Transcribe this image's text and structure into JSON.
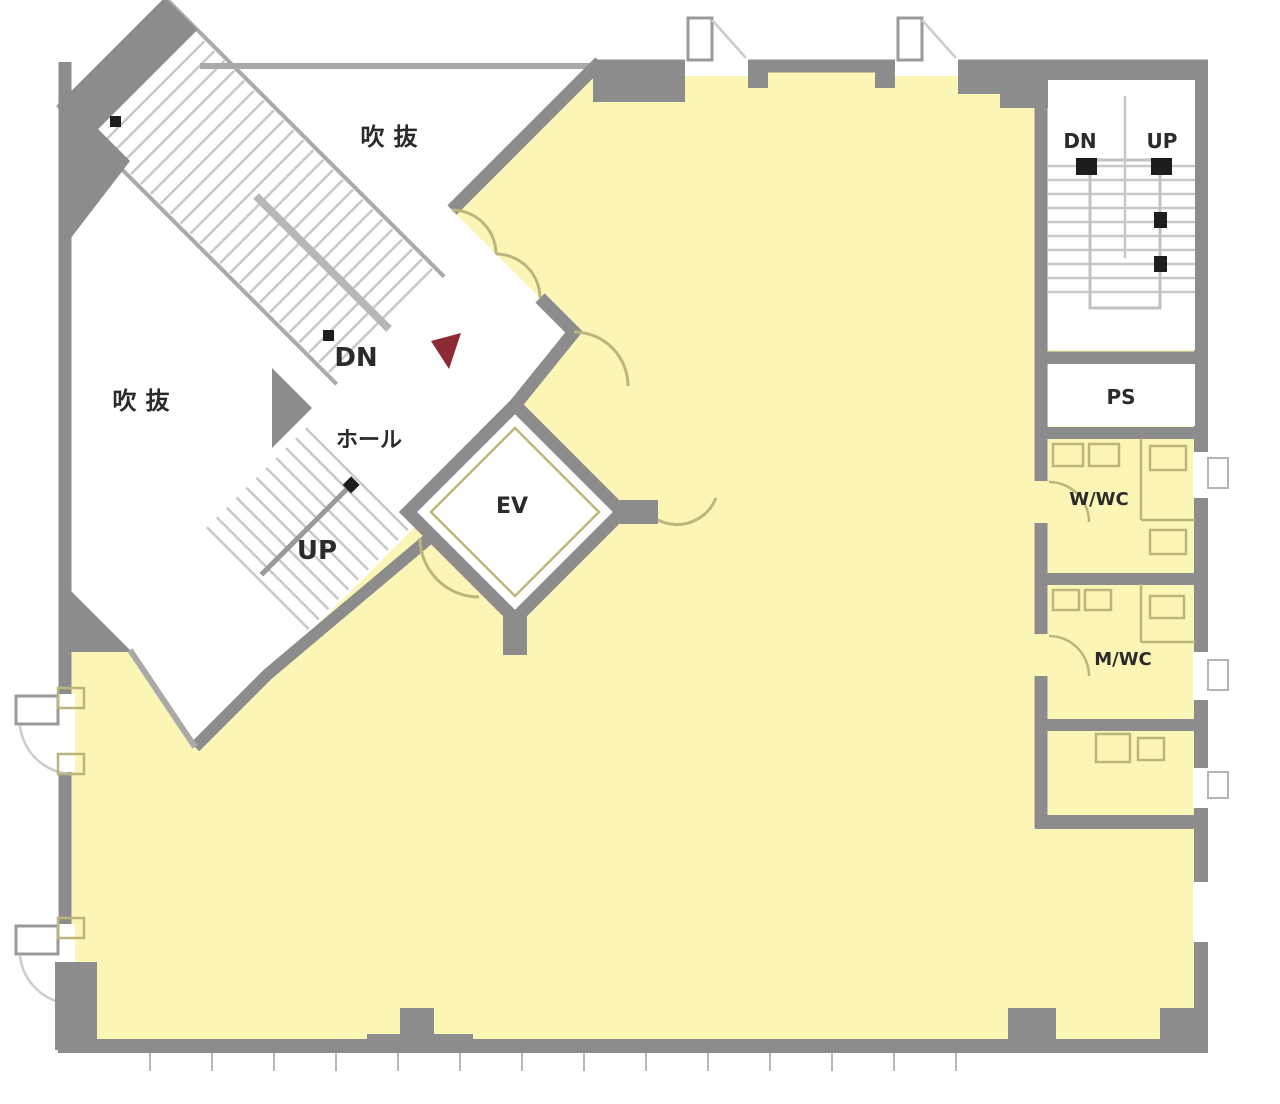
{
  "plan": {
    "labels": {
      "void_top": "吹抜",
      "void_left": "吹抜",
      "hall_dn": "DN",
      "hall": "ホール",
      "hall_up": "UP",
      "ev": "EV",
      "stair_dn": "DN",
      "stair_up": "UP",
      "ps": "PS",
      "w_wc": "W/WC",
      "m_wc": "M/WC"
    },
    "colors": {
      "floor": "#FBF5B6",
      "wall": "#8C8C8C",
      "wall_light": "#A9A9A9",
      "tread": "#C8C8C8",
      "fixture": "#BDB67C",
      "marker_red": "#8E2A34",
      "text": "#2B2B2B"
    }
  }
}
